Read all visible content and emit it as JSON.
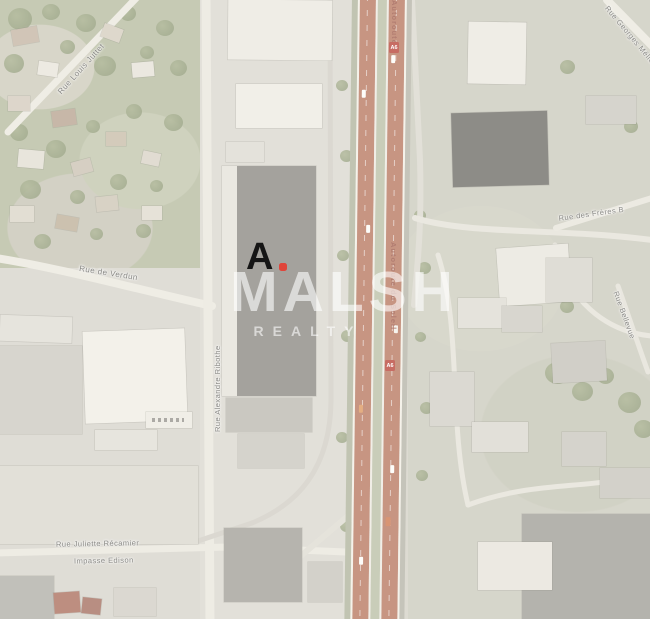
{
  "watermark": {
    "brand": "MALSH",
    "division": "REALTY"
  },
  "marker": {
    "glyph": "A",
    "dot_color": "#e0453a"
  },
  "highway": {
    "label_top": "Autoroute",
    "label_mid": "Autoroute du Soleil",
    "badge": "A6",
    "road_color": "#b06a50",
    "median_color": "#b4b99d"
  },
  "streets": {
    "louis_juttet": "Rue Louis Juttet",
    "verdun": "Rue de Verdun",
    "alexandre": "Rue Alexandre Ribothe",
    "recamier": "Rue Juliette Récamier",
    "edison": "Impasse Edison",
    "freres": "Rue des Frères B",
    "bellevue": "Rue Bellevue",
    "melies": "Rue Georges Méliès"
  },
  "colors": {
    "vegetation": "#afb596",
    "building_light": "#ece9df",
    "building_dark": "#5f5d56",
    "watermark_white": "rgba(255,255,255,0.6)"
  }
}
